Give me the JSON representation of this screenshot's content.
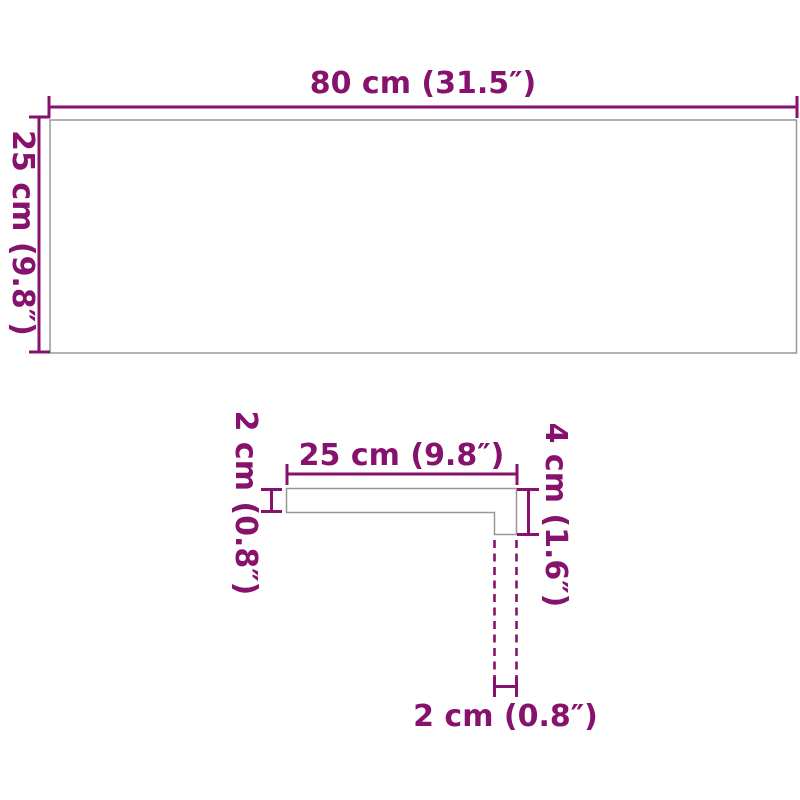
{
  "colors": {
    "accent": "#87126d",
    "outline": "#979797",
    "background": "#ffffff"
  },
  "top_view": {
    "width_label": "80 cm (31.5″)",
    "height_label": "25 cm (9.8″)"
  },
  "cross_section": {
    "tread_width_label": "25 cm (9.8″)",
    "tread_thickness_label": "2 cm (0.8″)",
    "nose_height_label": "4 cm (1.6″)",
    "nose_width_label": "2 cm (0.8″)"
  }
}
